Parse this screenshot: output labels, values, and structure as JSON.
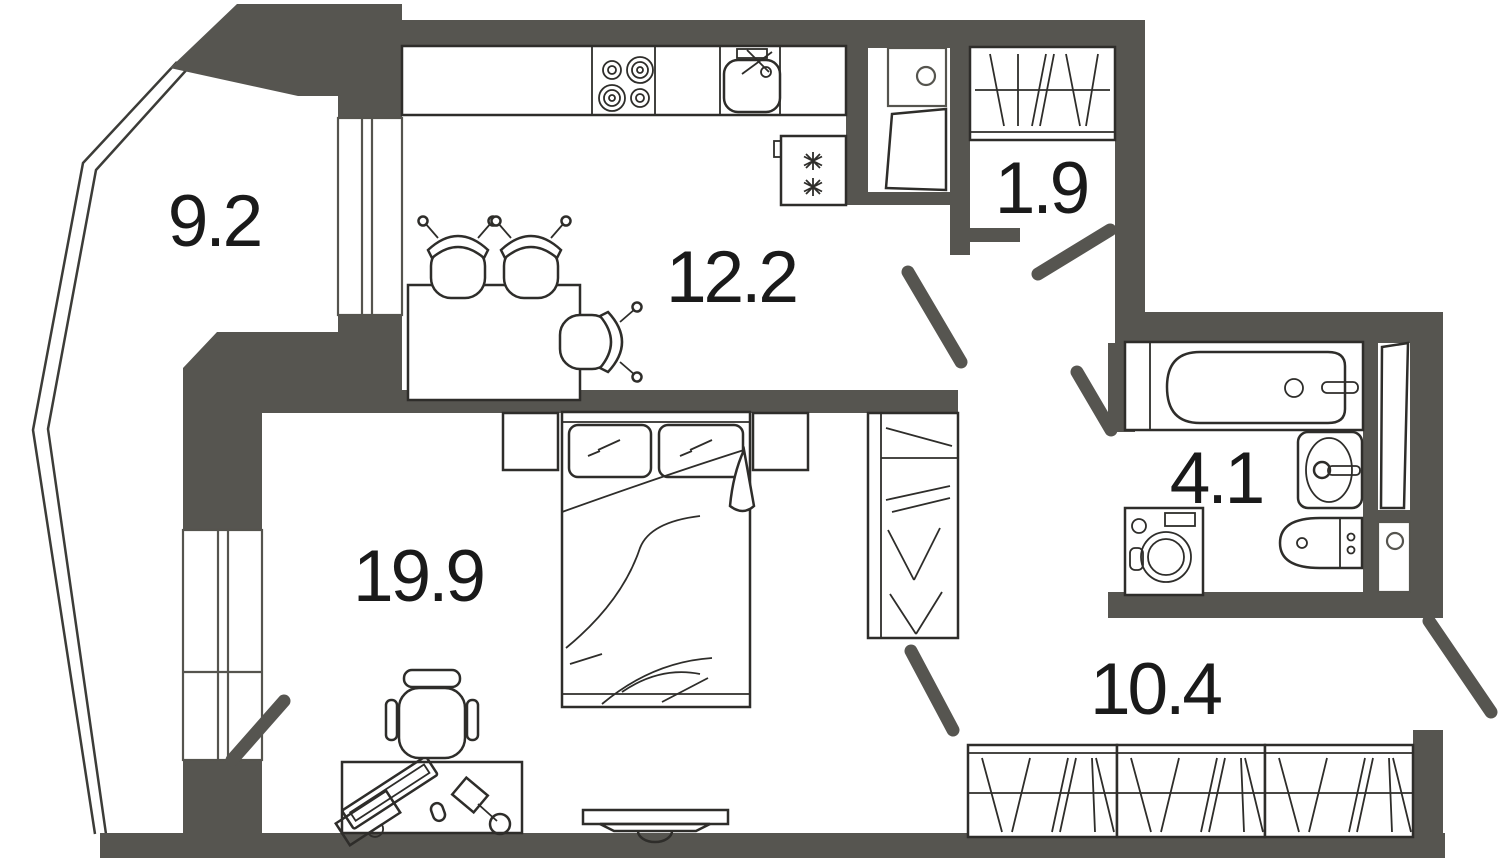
{
  "plan": {
    "type": "apartment-floor-plan",
    "background_color": "#ffffff",
    "wall_color": "#565550",
    "furniture_line_color": "#2e2d2a",
    "window_frame_color": "#55544e",
    "label_color": "#1a1a1a",
    "rooms": {
      "balcony": {
        "area": "9.2"
      },
      "kitchen": {
        "area": "12.2"
      },
      "hall": {
        "area": "1.9"
      },
      "bathroom": {
        "area": "4.1"
      },
      "living_room": {
        "area": "19.9"
      },
      "corridor": {
        "area": "10.4"
      }
    },
    "fixtures": [
      "cooktop",
      "kitchen-sink",
      "fridge",
      "vent-shaft",
      "dining-table",
      "dining-chairs",
      "double-bed",
      "pillows",
      "nightstands",
      "hall-wardrobe",
      "bedroom-wardrobe",
      "corridor-wardrobes",
      "desk",
      "computer-monitor",
      "keyboard",
      "mouse",
      "desk-lamp",
      "office-chair",
      "tv",
      "bathtub",
      "washbasin",
      "toilet",
      "washing-machine",
      "entrance-door",
      "interior-doors",
      "windows",
      "balcony-glazing"
    ]
  }
}
